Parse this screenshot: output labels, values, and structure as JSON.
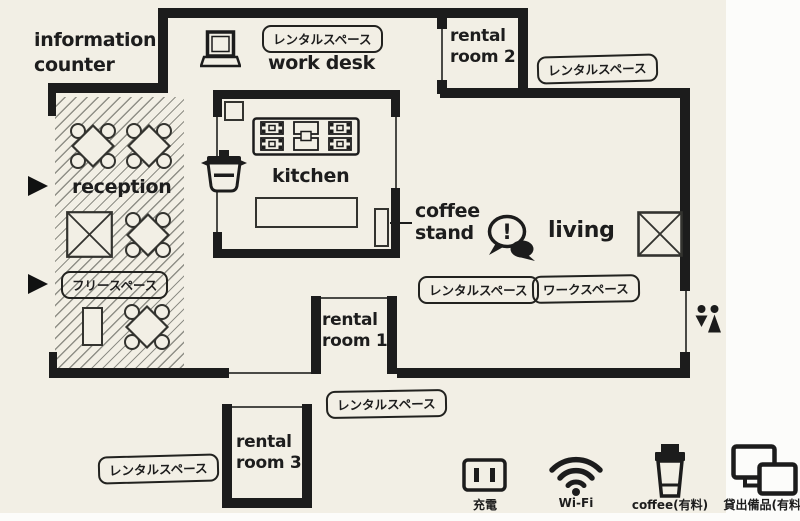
{
  "colors": {
    "paper": "#f2efe5",
    "wall": "#1c1c1c",
    "ink": "#1d1d1d",
    "hatch": "#8f8f87"
  },
  "areas": {
    "information_counter": {
      "line1": "information",
      "line2": "counter"
    },
    "work_desk": {
      "label": "work desk"
    },
    "reception": {
      "label": "reception"
    },
    "kitchen": {
      "label": "kitchen"
    },
    "coffee_stand": {
      "line1": "coffee",
      "line2": "stand"
    },
    "living": {
      "label": "living",
      "bubble": "!"
    },
    "rental_room_1": {
      "line1": "rental",
      "line2": "room 1"
    },
    "rental_room_2": {
      "line1": "rental",
      "line2": "room 2"
    },
    "rental_room_3": {
      "line1": "rental",
      "line2": "room 3"
    }
  },
  "tags": {
    "rental_space": "レンタルスペース",
    "free_space": "フリースペース",
    "work_space": "ワークスペース"
  },
  "legend": {
    "charge": "充電",
    "wifi": "Wi-Fi",
    "coffee": "coffee(有料)",
    "equipment": "貸出備品(有料)"
  },
  "icons": {
    "laptop": "laptop-icon",
    "pot": "cooking-pot-icon",
    "stove": "stove-icon",
    "speech_bubble": "speech-bubble-icon",
    "crossed_box": "crossed-box-icon",
    "restroom": "restroom-icon",
    "entrance_arrow": "entrance-arrow-icon",
    "outlet": "power-outlet-icon",
    "wifi": "wifi-icon",
    "coffee_cup": "coffee-cup-icon",
    "devices": "rental-devices-icon"
  }
}
